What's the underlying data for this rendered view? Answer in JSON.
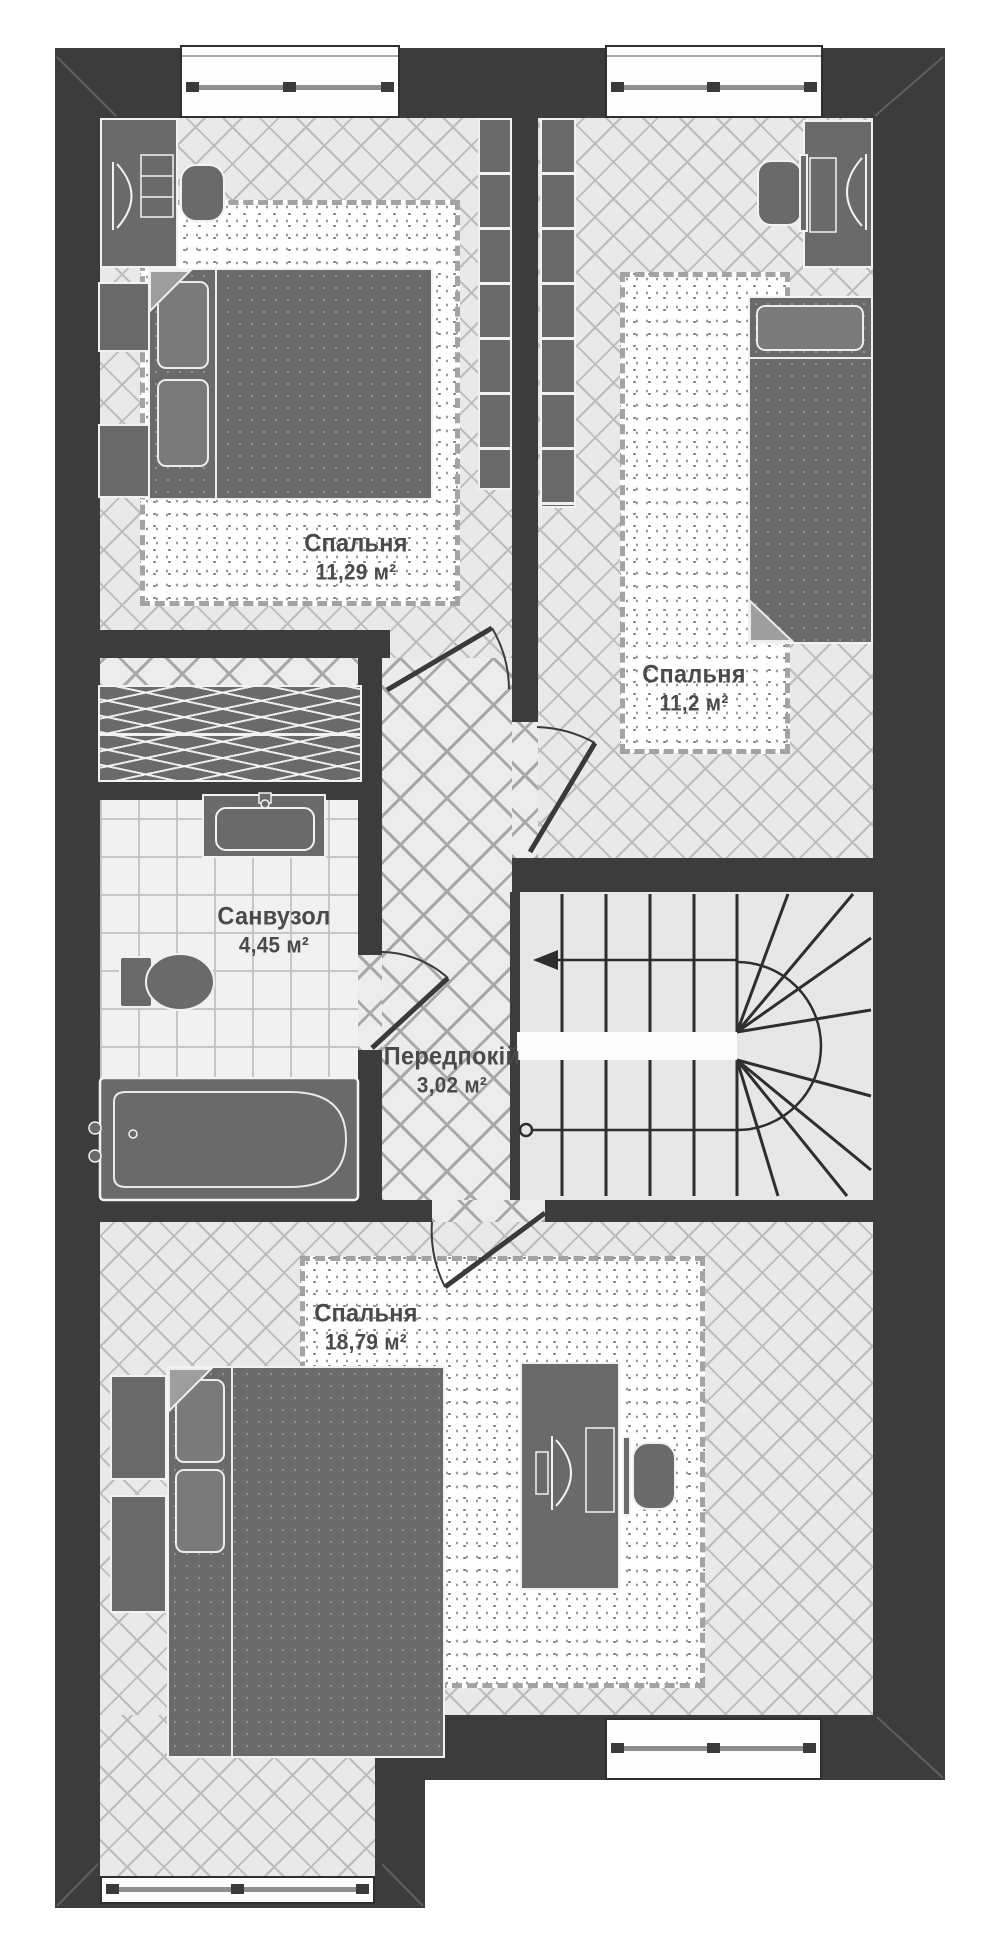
{
  "plan": {
    "rooms": [
      {
        "id": "bedroom-1",
        "name": "Спальня",
        "area": "11,29 м²"
      },
      {
        "id": "bedroom-2",
        "name": "Спальня",
        "area": "11,2 м²"
      },
      {
        "id": "bathroom",
        "name": "Санвузол",
        "area": "4,45 м²"
      },
      {
        "id": "hallway",
        "name": "Передпокій",
        "area": "3,02 м²"
      },
      {
        "id": "bedroom-3",
        "name": "Спальня",
        "area": "18,79 м²"
      }
    ],
    "colors": {
      "wall": "#3c3c3c",
      "floor": "#e9e9e9",
      "hall_floor": "#ececec",
      "tile": "#f1f1f1",
      "furniture": "#6a6a6a",
      "outline": "#f2f2f2",
      "carpet": "#ffffff",
      "text": "#4a4a4a",
      "background": "#ffffff"
    },
    "furniture": [
      "double-bed",
      "single-bed",
      "nightstand",
      "vanity-with-mirror",
      "stool",
      "shelving-unit",
      "wardrobe-hanging-clothes",
      "desk-with-computer",
      "office-chair",
      "bathtub",
      "toilet",
      "sink",
      "carpet"
    ],
    "stairs": {
      "type": "u-shaped-winder",
      "flights": 2,
      "arrow": "up-direction-arrow"
    },
    "window_count": 4,
    "door_count": 4
  }
}
